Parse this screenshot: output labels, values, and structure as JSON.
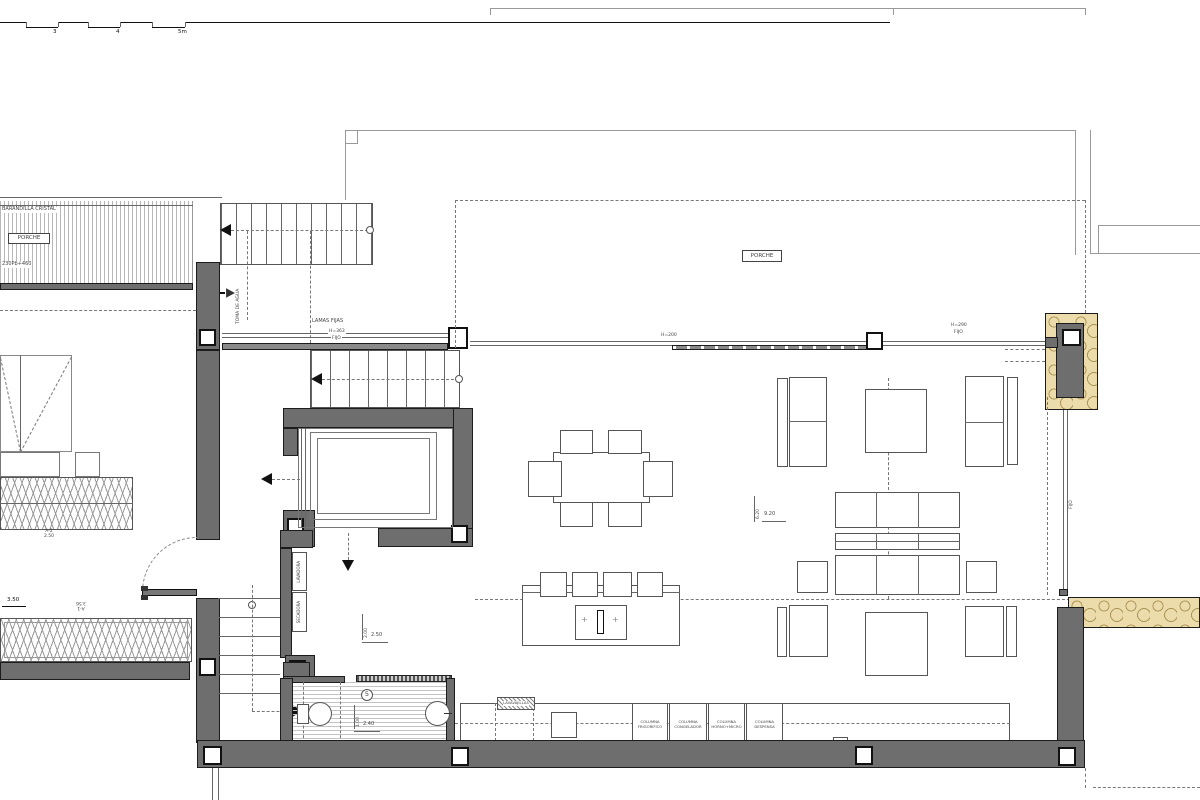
{
  "title": "Planta - vivienda (floor plan)",
  "colors": {
    "wall": "#6e6e6e",
    "stone": "#ecdcab",
    "line": "#555555",
    "dash": "#777777"
  },
  "scale_bar": {
    "labels": [
      "3",
      "4",
      "5m"
    ]
  },
  "porch_strip": {
    "barandilla": "BARANDILLA CRISTAL",
    "label": "PORCHE",
    "level": "230Pb+460"
  },
  "ann": {
    "toma": "TOMA DE AGUA",
    "lamas": "LAMAS FIJAS",
    "lamas_h": "H=363",
    "lamas_fijo": "FIJO",
    "porche": "PORCHE",
    "h200": "H=200",
    "h290": "H=290",
    "h290_fijo": "FIJO",
    "right_fijo": "FIJO"
  },
  "laundry": {
    "lavadora": "LAVADORA",
    "secadora": "SECADORA"
  },
  "bath": {
    "number": "5",
    "dim_w": "1.00",
    "dim_l": "2.40"
  },
  "hall": {
    "dim_w": "2.00",
    "dim_l": "2.50"
  },
  "living": {
    "dim_w": "6.20",
    "dim_l": "9.20"
  },
  "terrace": {
    "a2": "A-2",
    "a2_dim": "2.50",
    "a1": "A-1",
    "a1_dim": "3.56",
    "d350": "3.50"
  },
  "kitchen": {
    "lavavajillas": "LAVAVAJILLAS",
    "appliances": [
      {
        "l1": "COLUMNA",
        "l2": "FRIGORIFICO"
      },
      {
        "l1": "COLUMNA",
        "l2": "CONGELADOR"
      },
      {
        "l1": "COLUMNA",
        "l2": "HORNO+MICRO"
      },
      {
        "l1": "COLUMNA",
        "l2": "DESPENSA"
      }
    ]
  }
}
